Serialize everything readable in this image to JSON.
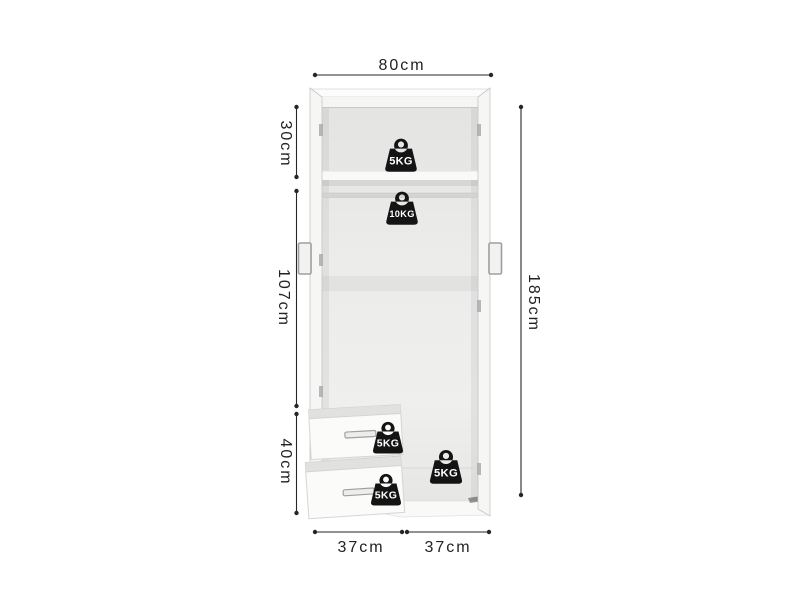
{
  "page": {
    "type": "product-dimension-diagram",
    "product": "two-door wardrobe with top shelf, hanging rail and two drawers",
    "background": "#ffffff"
  },
  "dimensions": {
    "top_width": "80cm",
    "upper_section_height": "30cm",
    "middle_section_height": "107cm",
    "lower_section_height": "40cm",
    "total_height": "185cm",
    "bottom_left_width": "37cm",
    "bottom_right_width": "37cm"
  },
  "load_capacity": {
    "top_shelf": "5KG",
    "hanging_rail": "10KG",
    "top_drawer": "5KG",
    "bottom_drawer": "5KG",
    "base_shelf": "5KG"
  },
  "colors": {
    "dimension_ink": "#222222",
    "weight_icon_fill": "#141414",
    "weight_label_text": "#ffffff",
    "cabinet_panel": "#f6f6f6",
    "cabinet_interior": "#e9e9e8",
    "handle_metal": "#a3a3a3"
  }
}
